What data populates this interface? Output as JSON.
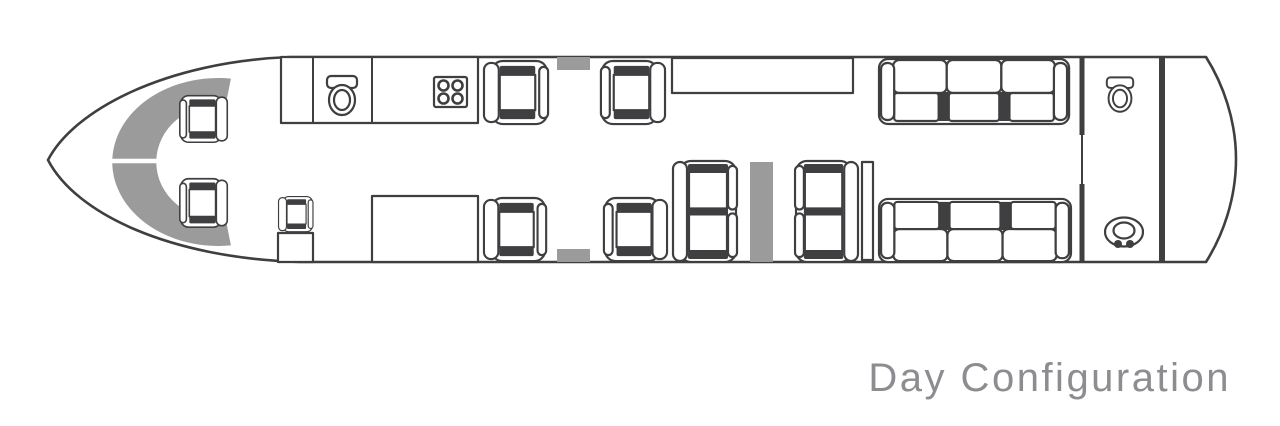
{
  "caption": "Day Configuration",
  "colors": {
    "line": "#3f3f41",
    "accent_gray": "#9b9b9b",
    "caption_gray": "#8d8d91",
    "background": "#ffffff"
  },
  "diagram": {
    "type": "aircraft-cabin-floorplan",
    "items": [
      {
        "name": "cockpit-instrument-panel",
        "count": 1
      },
      {
        "name": "pilot-seat",
        "count": 2
      },
      {
        "name": "cockpit-jump-seat",
        "count": 1
      },
      {
        "name": "forward-wardrobe",
        "count": 1
      },
      {
        "name": "forward-lavatory-toilet",
        "count": 1
      },
      {
        "name": "galley-stove",
        "count": 1
      },
      {
        "name": "forward-cabinet",
        "count": 1
      },
      {
        "name": "club-seat",
        "count": 4
      },
      {
        "name": "emergency-exit-marker",
        "count": 2
      },
      {
        "name": "credenza",
        "count": 1
      },
      {
        "name": "two-seat-divan",
        "count": 2
      },
      {
        "name": "mid-cabin-bulkhead",
        "count": 1
      },
      {
        "name": "side-panel",
        "count": 1
      },
      {
        "name": "three-seat-sofa",
        "count": 2
      },
      {
        "name": "aft-lavatory-toilet",
        "count": 1
      },
      {
        "name": "aft-lavatory-sink",
        "count": 1
      },
      {
        "name": "aft-partition",
        "count": 2
      }
    ]
  }
}
